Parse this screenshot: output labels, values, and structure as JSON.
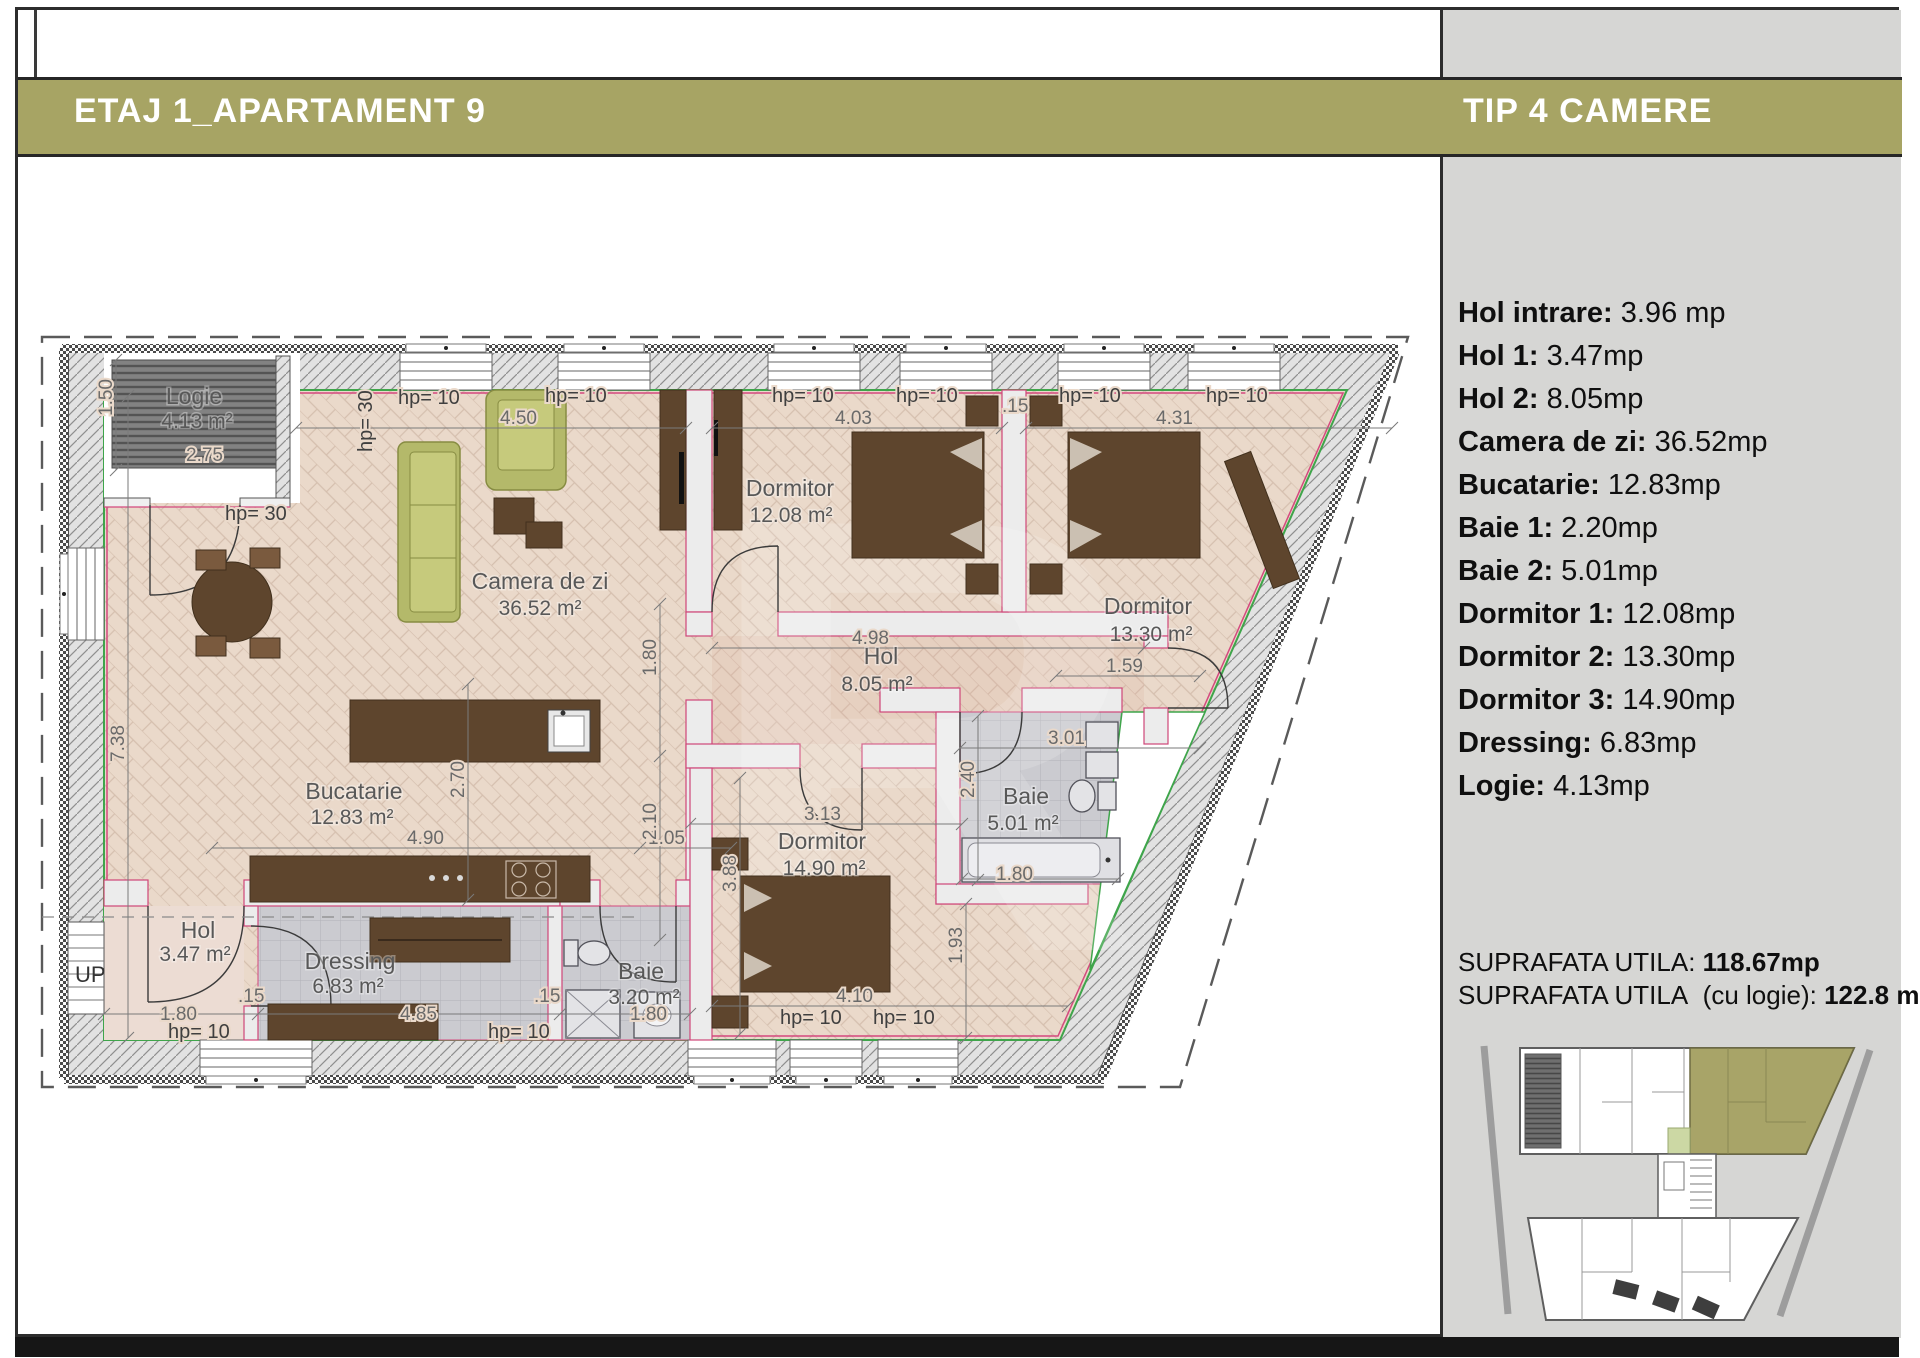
{
  "header": {
    "left_title": "ETAJ 1_APARTAMENT 9",
    "right_title": "TIP 4 CAMERE"
  },
  "sidebar": {
    "rooms": [
      {
        "label": "Hol intrare:",
        "value": "3.96 mp"
      },
      {
        "label": "Hol 1:",
        "value": "3.47mp"
      },
      {
        "label": "Hol 2:",
        "value": "8.05mp"
      },
      {
        "label": "Camera de zi:",
        "value": "36.52mp"
      },
      {
        "label": "Bucatarie:",
        "value": "12.83mp"
      },
      {
        "label": "Baie 1:",
        "value": "2.20mp"
      },
      {
        "label": "Baie 2:",
        "value": "5.01mp"
      },
      {
        "label": "Dormitor 1:",
        "value": "12.08mp"
      },
      {
        "label": "Dormitor 2:",
        "value": "13.30mp"
      },
      {
        "label": "Dormitor 3:",
        "value": "14.90mp"
      },
      {
        "label": "Dressing:",
        "value": "6.83mp"
      },
      {
        "label": "Logie:",
        "value": "4.13mp"
      }
    ],
    "total_label": "SUPRAFATA UTILA:",
    "total_value": "118.67mp",
    "total2_label": "SUPRAFATA UTILA",
    "total2_paren": "(cu logie):",
    "total2_value": "122.8 mp"
  },
  "plan": {
    "rooms": {
      "logie": {
        "name": "Logie",
        "area": "4.13 m²"
      },
      "camera": {
        "name": "Camera de zi",
        "area": "36.52 m²"
      },
      "bucatarie": {
        "name": "Bucatarie",
        "area": "12.83 m²"
      },
      "dormitor1": {
        "name": "Dormitor",
        "area": "12.08 m²"
      },
      "dormitor2": {
        "name": "Dormitor",
        "area": "13.30 m²"
      },
      "dormitor3": {
        "name": "Dormitor",
        "area": "14.90 m²"
      },
      "hol8": {
        "name": "Hol",
        "area": "8.05 m²"
      },
      "hol3": {
        "name": "Hol",
        "area": "3.47 m²"
      },
      "dressing": {
        "name": "Dressing",
        "area": "6.83 m²"
      },
      "baie2": {
        "name": "Baie",
        "area": "5.01 m²"
      },
      "baie3": {
        "name": "Baie",
        "area": "3.20 m²"
      }
    },
    "hp10": "hp= 10",
    "hp30": "hp= 30",
    "up": "UP",
    "dims": {
      "d450": "4.50",
      "d403": "4.03",
      "d431": "4.31",
      "d15": ".15",
      "d498": "4.98",
      "d159": "1.59",
      "d301": "3.01",
      "d313": "3.13",
      "d490": "4.90",
      "d105": "1.05",
      "d410": "4.10",
      "d180": "1.80",
      "d485": "4.85",
      "d275": "2.75",
      "d738": "7.38",
      "d150": "1.50",
      "d270": "2.70",
      "d210": "2.10",
      "d240": "2.40",
      "d388": "3.88",
      "d193": "1.93"
    }
  }
}
